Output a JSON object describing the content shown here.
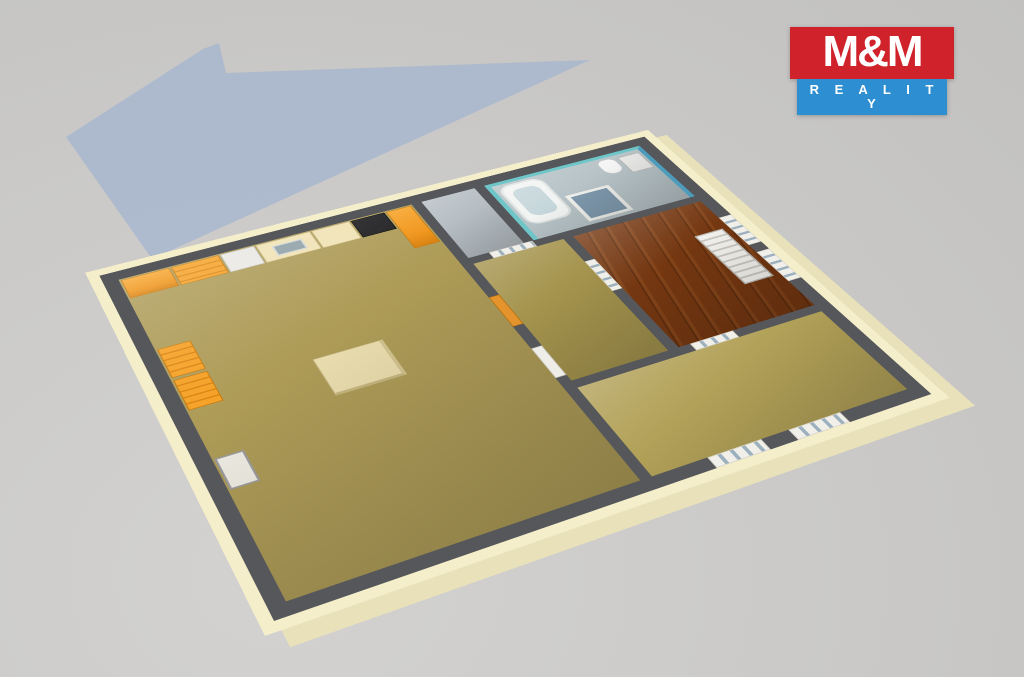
{
  "title": "3D apartment floor plan render",
  "logo": {
    "title": "M&M",
    "subtitle": "R E A L I T Y",
    "title_bg": "#d0222b",
    "subtitle_bg": "#2d8fd1",
    "text_color": "#ffffff"
  },
  "scene": {
    "background": "#cac9c7",
    "shadow_color": "#a9b8ce",
    "exterior_wall_color": "#f5eecb",
    "wall_top_color": "#55575b",
    "view": "isometric-top-down"
  },
  "rooms": [
    {
      "name": "living-room-with-kitchen",
      "floor_color": "#ad9b57"
    },
    {
      "name": "hallway",
      "floor_color": "#a5944e"
    },
    {
      "name": "wc",
      "floor_color": "#b6bec3"
    },
    {
      "name": "bathroom",
      "floor_color": "#b7c3c7",
      "accent_wall_light": "#6ec6c8",
      "accent_wall_dark": "#4d9cbb"
    },
    {
      "name": "bedroom",
      "floor_color": "#b2a158"
    },
    {
      "name": "bedroom-wood-floor",
      "floor_color": "#743711"
    }
  ],
  "fixtures": {
    "kitchen_cabinet_color": "#ef9215",
    "kitchen_counter_color": "#f0e2b4",
    "cooktop_color": "#1c1c1f",
    "appliance_color": "#e9e8e4",
    "island_color": "#eaddae",
    "bathtub_color": "#f2f4f3",
    "shower_glass_color": "#7f99ad",
    "radiator_color": "#f2f1ed",
    "entry_door_color": "#e5932c",
    "items": [
      "kitchen-counter",
      "kitchen-island",
      "sink",
      "cooktop",
      "tall-cabinet",
      "bathtub",
      "shower-enclosure",
      "toilet",
      "sink-vanity",
      "radiator",
      "glass-doors",
      "windows",
      "chimney-box"
    ]
  }
}
